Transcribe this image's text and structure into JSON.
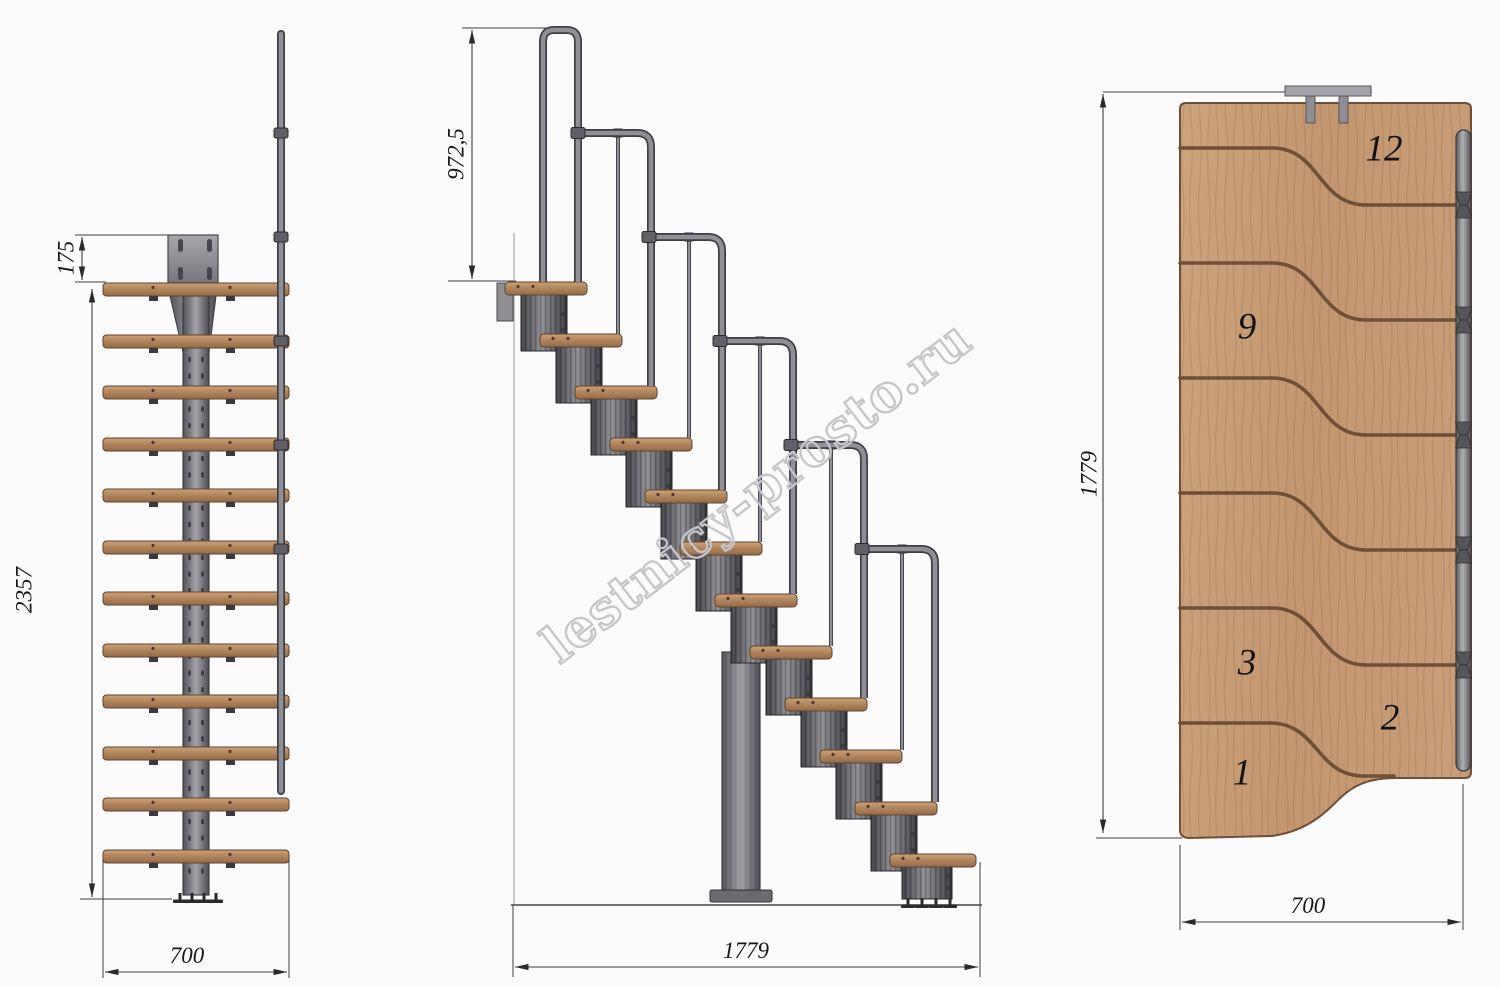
{
  "watermark": {
    "text": "lestnicy-prosto.ru"
  },
  "front": {
    "dim_offset": "175",
    "dim_height": "2357",
    "dim_width": "700"
  },
  "side": {
    "dim_rail": "972,5",
    "dim_length": "1779"
  },
  "plan": {
    "dim_length": "1779",
    "dim_width": "700",
    "treads": {
      "t12": "12",
      "t9": "9",
      "t3": "3",
      "t2": "2",
      "t1": "1"
    }
  },
  "colors": {
    "wood": "#b98e69",
    "wood_plan": "#c79c78",
    "metal": "#87878b",
    "line": "#3d3d42",
    "watermark_gray": "#c5c5ca",
    "background": "#fbfbfc"
  }
}
